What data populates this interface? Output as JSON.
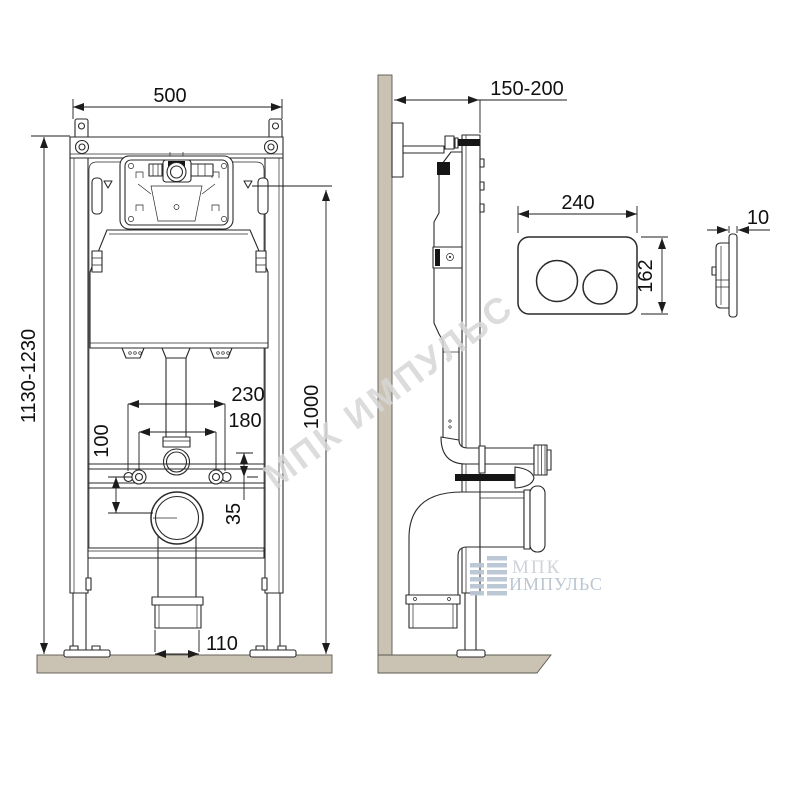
{
  "watermark": "МПК ИМПУЛЬС",
  "logo": {
    "line1": "МПК",
    "line2": "ИМПУЛЬС"
  },
  "front_view": {
    "dims": {
      "frame_width": "500",
      "install_height": "1130-1230",
      "top_marker_height": "1000",
      "supply_centers": "230",
      "fixing_centers": "180",
      "outlet_offset": "100",
      "supply_offset": "35",
      "outlet_socket_width": "110"
    }
  },
  "side_view": {
    "dims": {
      "frame_depth": "150-200"
    }
  },
  "flush_plate": {
    "dims": {
      "width": "240",
      "height": "162",
      "thickness": "10"
    }
  },
  "colors": {
    "line": "#2a2a2a",
    "surface": "#cac3b4",
    "watermark": "#d6d6d6",
    "logo_icon": "#b9c6d3",
    "logo_text_primary": "#cdd1d7",
    "logo_text_secondary": "#b8c3d0"
  }
}
